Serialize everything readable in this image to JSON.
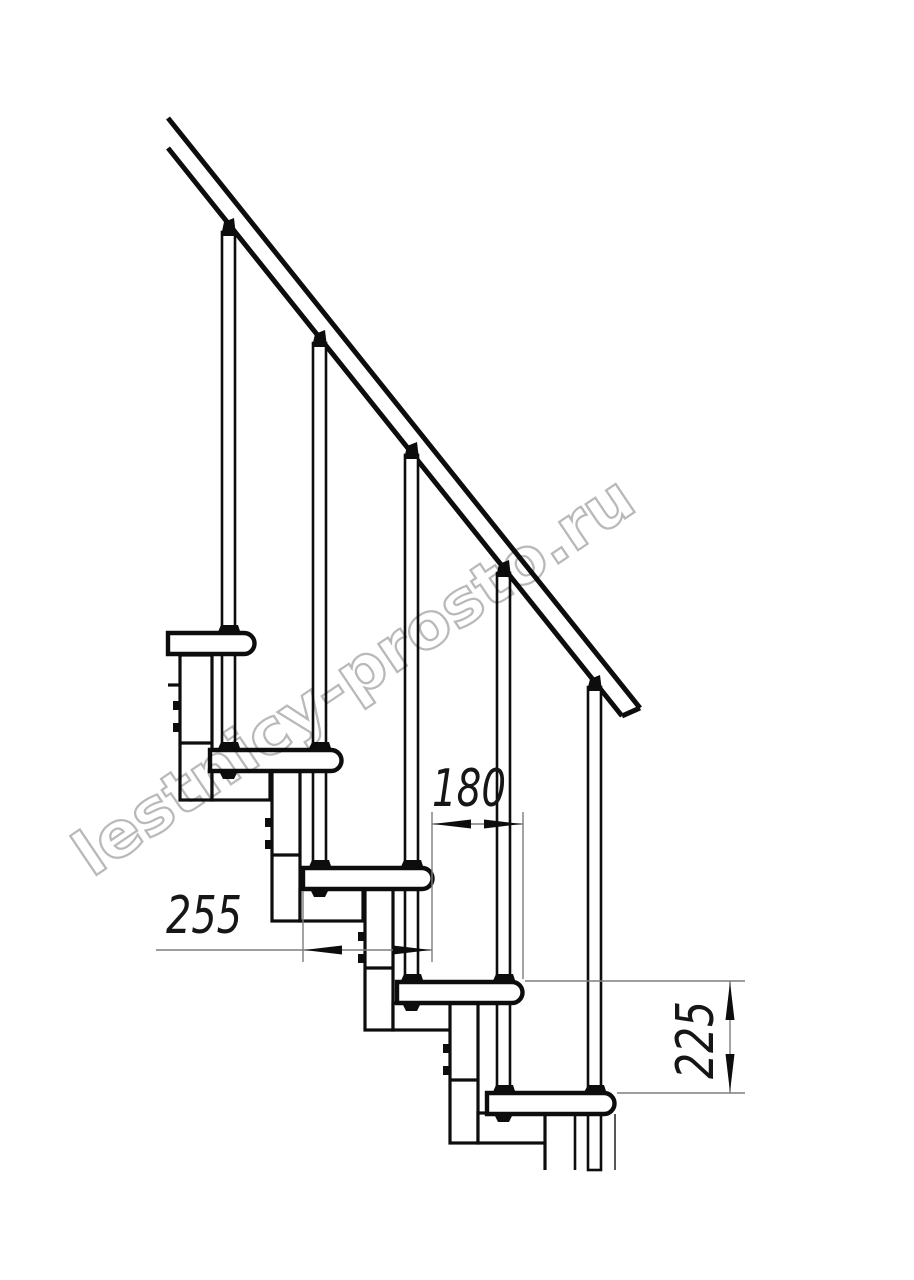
{
  "diagram": {
    "type": "technical-drawing",
    "subject": "modular staircase side elevation",
    "watermark": "lestnicy-prosto.ru",
    "dim_going": {
      "label": "180"
    },
    "dim_tread": {
      "label": "255"
    },
    "dim_rise": {
      "label": "225"
    },
    "structure": {
      "treads": 5,
      "balusters": 5,
      "handrail": true
    },
    "colors": {
      "ink": "#0d0d0d",
      "thin_line": "#7d7d7d",
      "watermark": "#b9b9b9",
      "background": "#ffffff"
    }
  }
}
